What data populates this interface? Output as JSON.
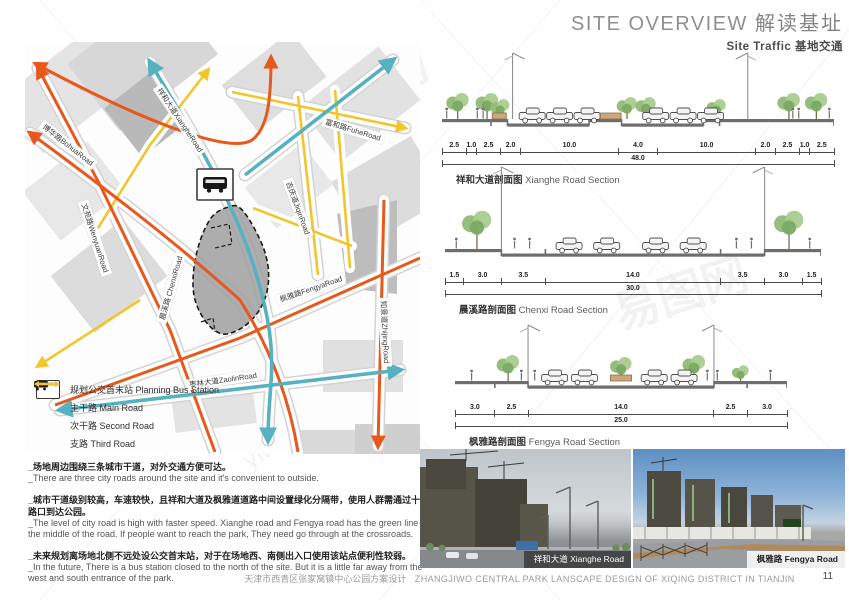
{
  "header": {
    "title_en": "SITE OVERVIEW",
    "title_zh": "解读基址",
    "subtitle_en": "Site Traffic",
    "subtitle_zh": "基地交通"
  },
  "map": {
    "roads": [
      {
        "label": "博华路BohuaRoad"
      },
      {
        "label": "文苑路WenyuanRoad"
      },
      {
        "label": "祥和大道XiangheRoad"
      },
      {
        "label": "富和路FuheRoad"
      },
      {
        "label": "吉庆道JiqinRoad"
      },
      {
        "label": "晨溪路 ChenxiRoad"
      },
      {
        "label": "枫雅路FengyaRoad"
      },
      {
        "label": "枣林大道ZaolinRoad"
      },
      {
        "label": "知景道ZhijingRoad"
      }
    ],
    "legend": [
      {
        "type": "bus",
        "label": "规划公交首末站 Planning Bus Station"
      },
      {
        "type": "arrow",
        "color": "#56b1c0",
        "label": "主干路 Main Road"
      },
      {
        "type": "arrow",
        "color": "#e8571b",
        "label": "次干路 Second Road"
      },
      {
        "type": "arrow",
        "color": "#f2c52d",
        "label": "支路 Third Road"
      }
    ],
    "colors": {
      "main_road": "#56b1c0",
      "second_road": "#e8571b",
      "third_road": "#f2c52d"
    }
  },
  "sections": [
    {
      "caption_zh": "祥和大道剖面图",
      "caption_en": "Xianghe Road Section",
      "dims": [
        2.5,
        1.0,
        2.5,
        2.0,
        10.0,
        4.0,
        10.0,
        2.0,
        2.5,
        1.0,
        2.5
      ],
      "total": 48.0
    },
    {
      "caption_zh": "晨溪路剖面图",
      "caption_en": "Chenxi Road Section",
      "dims": [
        1.5,
        3.0,
        3.5,
        14.0,
        3.5,
        3.0,
        1.5
      ],
      "total": 30.0
    },
    {
      "caption_zh": "枫雅路剖面图",
      "caption_en": "Fengya Road Section",
      "dims": [
        3.0,
        2.5,
        14.0,
        2.5,
        3.0
      ],
      "total": 25.0
    }
  ],
  "notes": [
    {
      "zh": "_场地周边围绕三条城市干道，对外交通方便可达。",
      "en": "_There are three city roads around  the  site and it's convenient to outside."
    },
    {
      "zh": "_城市干道级别较高，车速较快，且祥和大道及枫雅道道路中间设置绿化分隔带，使用人群需通过十字路口到达公园。",
      "en": "_The level of city road is high with faster speed. Xianghe road and Fengya road has the green line in the middle of the road. If people want to reach the park, They need go through at the crossroads."
    },
    {
      "zh": "_未来规划离场地北侧不远处设公交首末站，对于在场地西、南侧出入口使用该站点便利性较弱。",
      "en": "_In the future, There is a bus station closed to the north of the site. But it is a little far away from the west and south entrance of the park."
    }
  ],
  "photos": [
    {
      "caption": "祥和大道 Xianghe Road"
    },
    {
      "caption": "枫雅路 Fengya Road"
    }
  ],
  "footer": {
    "zh": "天津市西青区张家窝镇中心公园方案设计",
    "en": "ZHANGJIWO CENTRAL PARK LANSCAPE DESIGN OF XIQING DISTRICT IN TIANJIN",
    "page": "11"
  },
  "watermark": {
    "brand": "易图网",
    "domain": "yitu.cn"
  }
}
